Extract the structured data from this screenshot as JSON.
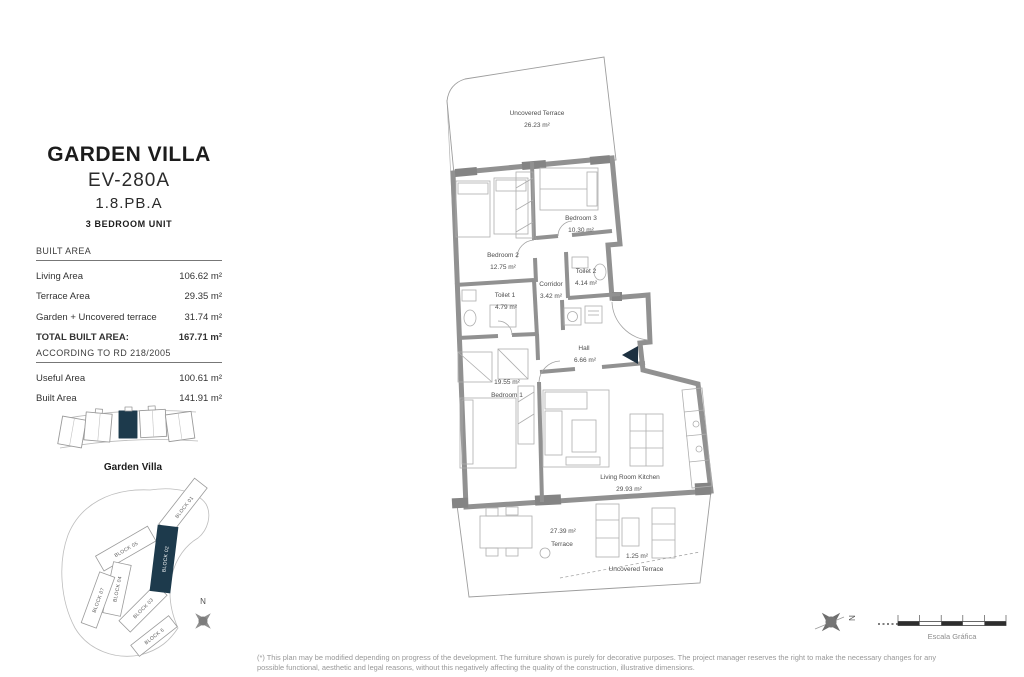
{
  "colors": {
    "accent": "#1d3a4c",
    "wall": "#919191",
    "thin_line": "#9d9d9d",
    "furniture_line": "#aeaeae",
    "text_dark": "#1c1c1c",
    "text_muted": "#989898"
  },
  "header": {
    "title": "GARDEN VILLA",
    "unit_code": "EV-280A",
    "plan_code": "1.8.PB.A",
    "unit_type": "3 BEDROOM UNIT"
  },
  "built_area": {
    "header": "BUILT AREA",
    "rows": [
      {
        "label": "Living Area",
        "value": "106.62 m²"
      },
      {
        "label": "Terrace Area",
        "value": "29.35 m²"
      },
      {
        "label": "Garden + Uncovered terrace",
        "value": "31.74 m²"
      }
    ],
    "total_label": "TOTAL BUILT AREA:",
    "total_value": "167.71 m²"
  },
  "rd_area": {
    "header": "ACCORDING TO RD 218/2005",
    "rows": [
      {
        "label": "Useful Area",
        "value": "100.61 m²"
      },
      {
        "label": "Built Area",
        "value": "141.91 m²"
      }
    ]
  },
  "location": {
    "strip_caption": "Garden Villa",
    "blocks": [
      "BLOCK 01",
      "BLOCK 02",
      "BLOCK 05",
      "BLOCK 04",
      "BLOCK 07",
      "BLOCK 03",
      "BLOCK 6"
    ],
    "highlighted_block": "BLOCK 02",
    "compass_label": "N"
  },
  "floorplan": {
    "rooms": [
      {
        "name": "Uncovered Terrace",
        "area": "26.23 m²"
      },
      {
        "name": "Bedroom 2",
        "area": "12.75 m²"
      },
      {
        "name": "Bedroom 3",
        "area": "10.30 m²"
      },
      {
        "name": "Toilet 2",
        "area": "4.14 m²"
      },
      {
        "name": "Corridor",
        "area": "3.42 m²"
      },
      {
        "name": "Toilet 1",
        "area": "4.79 m²"
      },
      {
        "name": "Hall",
        "area": "6.66 m²"
      },
      {
        "name": "Bedroom 1",
        "area": "19.55 m²"
      },
      {
        "name": "Living Room Kitchen",
        "area": "29.93 m²"
      },
      {
        "name": "Terrace",
        "area": "27.39 m²"
      },
      {
        "name": "Uncovered Terrace",
        "area": "1.25 m²"
      }
    ]
  },
  "footer": {
    "disclaimer_line1": "(*) This plan may be modified depending on progress of the development. The furniture shown is purely for decorative purposes. The project manager reserves the right to make the necessary changes for any",
    "disclaimer_line2": "possible functional, aesthetic and legal reasons, without this negatively affecting the quality of the construction, illustrative dimensions.",
    "scale_label": "Escala Gráfica",
    "compass_label": "N"
  }
}
